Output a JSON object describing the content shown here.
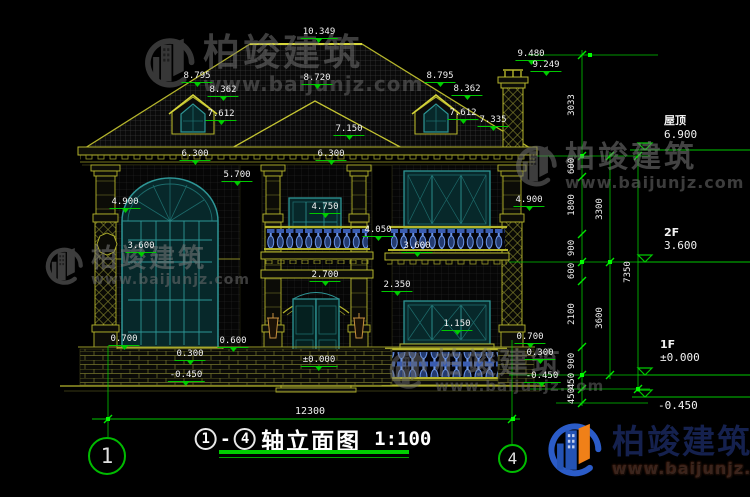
{
  "watermark": {
    "company": "柏竣建筑",
    "website": "www.baijunjz.com"
  },
  "title_block": {
    "axis_start": "1",
    "axis_end": "4",
    "separator": "-",
    "name": "轴立面图",
    "scale": "1:100"
  },
  "overall_dim": {
    "text": "12300"
  },
  "axis_bubbles": [
    {
      "label": "1",
      "x": 88,
      "y": 437,
      "d": 38
    },
    {
      "label": "4",
      "x": 498,
      "y": 444,
      "d": 29
    }
  ],
  "levels": [
    {
      "name": "屋顶",
      "value": "6.900",
      "x": 664,
      "y": 112
    },
    {
      "name": "2F",
      "value": "3.600",
      "x": 664,
      "y": 226
    },
    {
      "name": "1F",
      "value": "±0.000",
      "x": 660,
      "y": 338
    },
    {
      "name": "",
      "value": "-0.450",
      "x": 658,
      "y": 399
    }
  ],
  "spot_elevations": [
    {
      "text": "10.349",
      "x": 319,
      "y": 27
    },
    {
      "text": "9.480",
      "x": 531,
      "y": 49
    },
    {
      "text": "9.249",
      "x": 546,
      "y": 60
    },
    {
      "text": "8.795",
      "x": 197,
      "y": 71
    },
    {
      "text": "8.362",
      "x": 223,
      "y": 85
    },
    {
      "text": "7.612",
      "x": 221,
      "y": 109
    },
    {
      "text": "8.720",
      "x": 317,
      "y": 73
    },
    {
      "text": "8.795",
      "x": 440,
      "y": 71
    },
    {
      "text": "8.362",
      "x": 467,
      "y": 84
    },
    {
      "text": "7.612",
      "x": 463,
      "y": 108
    },
    {
      "text": "7.150",
      "x": 349,
      "y": 124
    },
    {
      "text": "7.335",
      "x": 493,
      "y": 115
    },
    {
      "text": "6.300",
      "x": 195,
      "y": 149
    },
    {
      "text": "6.300",
      "x": 331,
      "y": 149
    },
    {
      "text": "5.700",
      "x": 237,
      "y": 170
    },
    {
      "text": "4.900",
      "x": 125,
      "y": 197
    },
    {
      "text": "4.900",
      "x": 529,
      "y": 195
    },
    {
      "text": "4.750",
      "x": 325,
      "y": 202
    },
    {
      "text": "4.050",
      "x": 378,
      "y": 225
    },
    {
      "text": "3.600",
      "x": 141,
      "y": 241
    },
    {
      "text": "3.600",
      "x": 417,
      "y": 241
    },
    {
      "text": "2.700",
      "x": 325,
      "y": 270
    },
    {
      "text": "2.350",
      "x": 397,
      "y": 280
    },
    {
      "text": "1.150",
      "x": 457,
      "y": 319
    },
    {
      "text": "0.700",
      "x": 124,
      "y": 334
    },
    {
      "text": "0.600",
      "x": 233,
      "y": 336
    },
    {
      "text": "0.300",
      "x": 190,
      "y": 349
    },
    {
      "text": "±0.000",
      "x": 319,
      "y": 355
    },
    {
      "text": "-0.450",
      "x": 186,
      "y": 370
    },
    {
      "text": "0.700",
      "x": 530,
      "y": 332
    },
    {
      "text": "0.300",
      "x": 540,
      "y": 348
    },
    {
      "text": "-0.450",
      "x": 542,
      "y": 371
    }
  ],
  "dim_chains": [
    {
      "x": 572,
      "labels": [
        {
          "text": "3033",
          "y": 105
        },
        {
          "text": "600",
          "y": 166
        },
        {
          "text": "1800",
          "y": 205
        },
        {
          "text": "900",
          "y": 248
        },
        {
          "text": "600",
          "y": 271
        },
        {
          "text": "2100",
          "y": 314
        },
        {
          "text": "900",
          "y": 361
        },
        {
          "text": "450",
          "y": 381
        },
        {
          "text": "450",
          "y": 396
        }
      ]
    },
    {
      "x": 600,
      "labels": [
        {
          "text": "3300",
          "y": 209
        },
        {
          "text": "3600",
          "y": 318
        }
      ]
    },
    {
      "x": 628,
      "labels": [
        {
          "text": "7350",
          "y": 272
        }
      ]
    }
  ],
  "colors": {
    "dim_green": "#00c800",
    "line_yellow": "#b5b52c",
    "frame_teal": "#2e9696",
    "baluster_blue": "#5b85d8",
    "brand_blue": "#2453b4",
    "brand_orange": "#f08018"
  }
}
